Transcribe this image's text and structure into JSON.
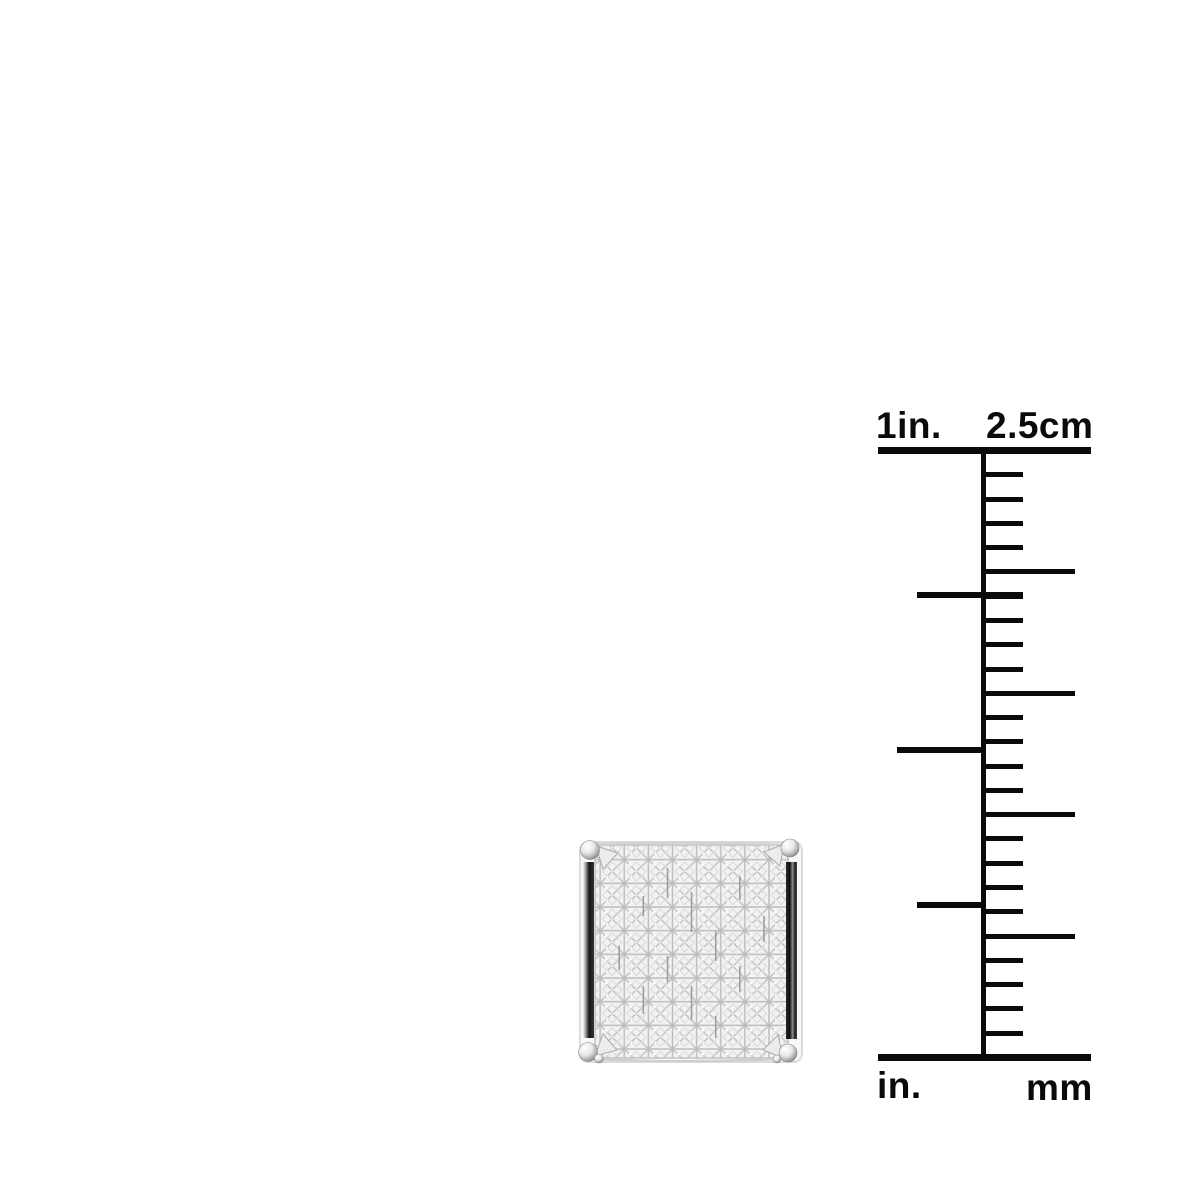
{
  "page": {
    "background": "#ffffff"
  },
  "ruler": {
    "labels": {
      "top_left": "1in.",
      "top_right": "2.5cm",
      "bottom_left": "in.",
      "bottom_right": "mm"
    },
    "color": "#0a0a0a",
    "geometry": {
      "left": 878,
      "width": 213,
      "axis_x": 981,
      "axis_w": 5,
      "top_y": 447,
      "bottom_y": 1054,
      "bar_h": 7,
      "mm_tick_count": 24,
      "mm_long_every": 5,
      "tick_h": 5,
      "inch_tick_h": 6,
      "short_len": 42,
      "long_len": 94,
      "inch_ticks": [
        {
          "y": 595,
          "x1": 917,
          "x2": 1023
        },
        {
          "y": 750,
          "x1": 897,
          "x2": 983
        },
        {
          "y": 905,
          "x1": 917,
          "x2": 983
        }
      ]
    }
  },
  "earring": {
    "stone_grid": {
      "columns": 8,
      "rows": 9
    },
    "colors": {
      "diamond": "#f2f2f2",
      "facet_line": "#c6c6c6",
      "metal_light": "#f8f8f8",
      "metal_mid": "#b5b5b5",
      "metal_dark": "#141414"
    }
  }
}
